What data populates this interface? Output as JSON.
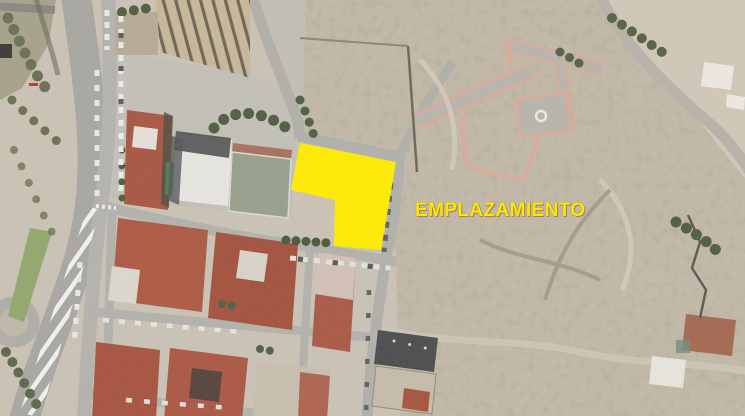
{
  "annotation": {
    "label": "EMPLAZAMIENTO"
  },
  "colors": {
    "site": "#FFEC00",
    "label": "#FFE500",
    "terrain": "#CBC3B4",
    "scrub": "#C2B8A6",
    "road": "#AFADA7",
    "roof-red": "#A85743",
    "building-white": "#E8E6E0",
    "vegetation": "#55653F",
    "path-pink": "#D9AB9B",
    "median-green": "#93A86D"
  }
}
